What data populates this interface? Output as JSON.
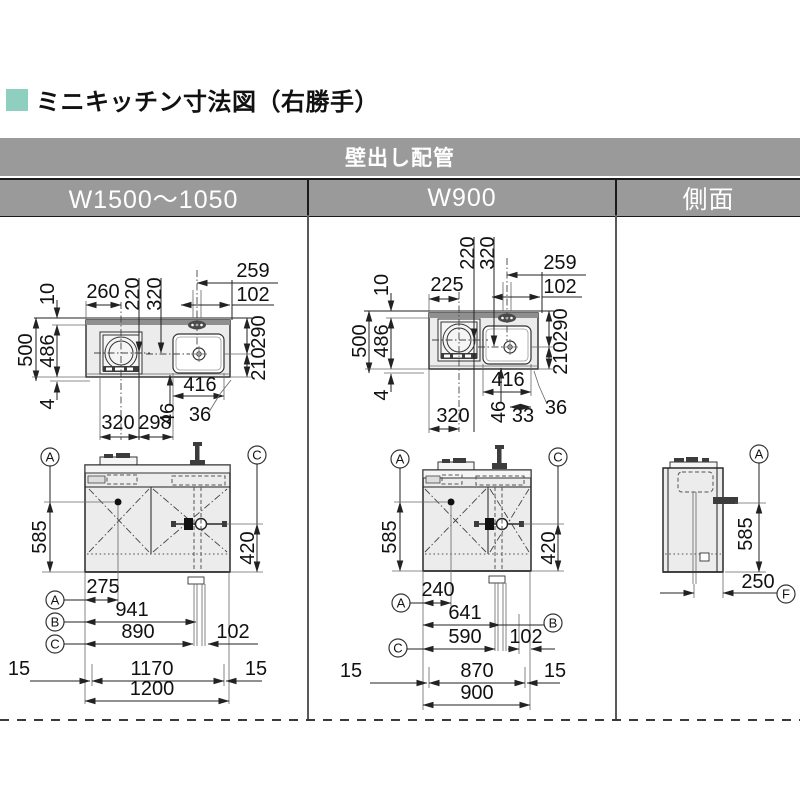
{
  "page": {
    "title": "ミニキッチン寸法図（右勝手）"
  },
  "table": {
    "top_header": "壁出し配管",
    "columns": [
      "W1500～1050",
      "W900",
      "側面"
    ]
  },
  "refs": {
    "a": "A",
    "b": "B",
    "c": "C",
    "f": "F"
  },
  "colors": {
    "accent": "#8ecfc0",
    "header_bg": "#9a9a9a"
  },
  "w1500": {
    "plan": {
      "back_offset": "10",
      "total_depth": "500",
      "counter_depth": "486",
      "front_lip": "4",
      "cooktop_left": "260",
      "cooktop_center_depth": "220",
      "sink_center_depth": "320",
      "tap_to_edge": "259",
      "tap_offset": "102",
      "sink_back": "290",
      "sink_front": "210",
      "sink_width": "416",
      "sink_gap": "46",
      "edge_gap": "36",
      "bottom_left": "320",
      "bottom_right": "298"
    },
    "front": {
      "height_handle": "585",
      "height_valve": "420",
      "dim_a": "275",
      "dim_b": "941",
      "dim_c": "890",
      "dim_c2": "102",
      "margin_left": "15",
      "inner_width": "1170",
      "margin_right": "15",
      "total_width": "1200"
    }
  },
  "w900": {
    "plan": {
      "back_offset": "10",
      "total_depth": "500",
      "counter_depth": "486",
      "front_lip": "4",
      "cooktop_left": "225",
      "cooktop_center_depth": "220",
      "sink_center_depth": "320",
      "tap_to_edge": "259",
      "tap_offset": "102",
      "sink_back": "290",
      "sink_front": "210",
      "sink_width": "416",
      "sink_gap": "46",
      "drain_gap": "33",
      "edge_gap": "36",
      "bottom_left": "320"
    },
    "front": {
      "height_handle": "585",
      "height_valve": "420",
      "dim_a": "240",
      "dim_b": "641",
      "dim_c": "590",
      "dim_c2": "102",
      "margin_left": "15",
      "inner_width": "870",
      "margin_right": "15",
      "total_width": "900"
    }
  },
  "side": {
    "height": "585",
    "depth": "250"
  }
}
